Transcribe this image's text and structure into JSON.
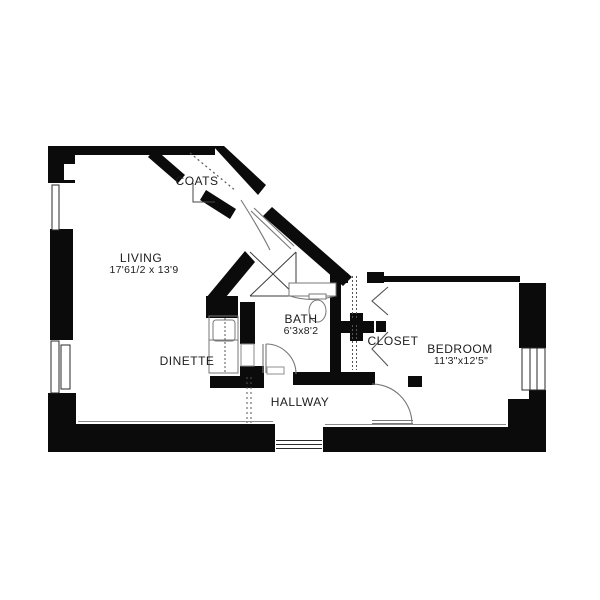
{
  "plan_title": "Apartment floor plan",
  "rooms": {
    "coats": {
      "label": "COATS"
    },
    "living": {
      "label": "LIVING",
      "dims": "17'61/2 x 13'9"
    },
    "bath": {
      "label": "BATH",
      "dims": "6'3x8'2"
    },
    "closet": {
      "label": "CLOSET"
    },
    "bedroom": {
      "label": "BEDROOM",
      "dims": "11'3\"x12'5\""
    },
    "dinette": {
      "label": "DINETTE"
    },
    "hallway": {
      "label": "HALLWAY"
    }
  },
  "colors": {
    "ink": "#0b0b0b",
    "thin_line": "#888888",
    "background": "#ffffff",
    "text": "#1c1c1c"
  }
}
